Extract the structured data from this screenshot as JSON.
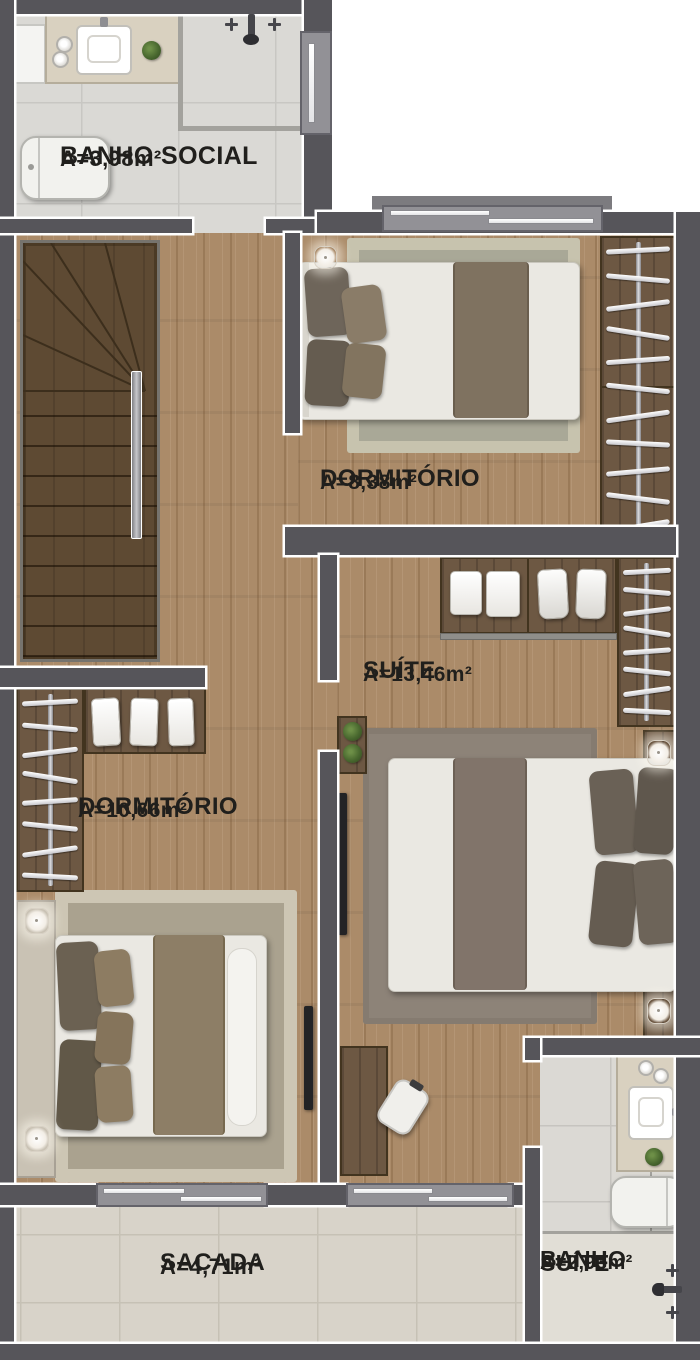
{
  "plan": {
    "type": "apartment-floor-plan",
    "rooms": [
      {
        "id": "banho-social",
        "name": "BANHO SOCIAL",
        "area": "A=3,98m²"
      },
      {
        "id": "dormitorio-1",
        "name": "DORMITÓRIO",
        "area": "A=8,38m²"
      },
      {
        "id": "suite",
        "name": "SUÍTE",
        "area": "A=13,46m²"
      },
      {
        "id": "dormitorio-2",
        "name": "DORMITÓRIO",
        "area": "A=10,66m²"
      },
      {
        "id": "sacada",
        "name": "SACADA",
        "area": "A=4,71m²"
      },
      {
        "id": "banho-suite",
        "name_line1": "BANHO",
        "name_line2": "SUÍTE",
        "area": "A=2,93m²"
      }
    ],
    "colors": {
      "wall": "#56555a",
      "wood_floor": "#ab8b69",
      "stair_wood": "#5e4a33",
      "bath_tile": "#dad9d5",
      "balcony_tile": "#d8d3c9",
      "closet_wood": "#6d5843",
      "label_text": "#201f1c"
    }
  }
}
